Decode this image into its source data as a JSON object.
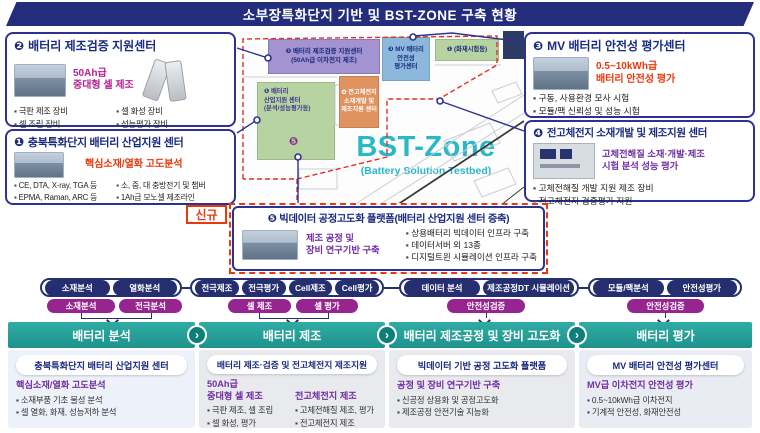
{
  "title": "소부장특화단지 기반 및 BST-ZONE  구축 현황",
  "badge_new": "신규",
  "colors": {
    "navy": "#2e3192",
    "title_bar": "#232d7b",
    "teal_header": "#23a39c",
    "red_accent": "#e8380d",
    "purple_accent": "#7030a0",
    "magenta_accent": "#b5208f",
    "bst_cyan": "#29b8c5",
    "dark_pill": "#252e6e",
    "purple_pill": "#97258f"
  },
  "boxes": {
    "b2": {
      "num": "❷",
      "title": "배터리 제조검증 지원센터",
      "hl1": "50Ah급",
      "hl2": "중대형 셀 제조",
      "bullets": [
        "극판 제조 장비",
        "셀 화성 장비",
        "셀 조립 장비",
        "성능평가 장비"
      ]
    },
    "b1": {
      "num": "❶",
      "title": "충북특화단지 배터리 산업지원 센터",
      "hl1": "핵심소재/열화 고도분석",
      "bullets": [
        "CE, DTA, X-ray, TGA 등",
        "소, 중, 대 충방전기 및 챔버",
        "EPMA, Raman, ARC 등",
        "1Ah급 모노셀 제조라인"
      ]
    },
    "b3": {
      "num": "❸",
      "title": "MV 배터리 안전성 평가센터",
      "hl1": "0.5~10kWh급",
      "hl2": "배터리 안전성 평가",
      "bullets": [
        "구동, 사용환경 모사 시험",
        "모듈/팩 신뢰성 및 성능 시험"
      ]
    },
    "b4": {
      "num": "❹",
      "title": "전고체전지 소재개발 및 제조지원 센터",
      "hl1": "고체전해질 소재·개발·제조",
      "hl2": "시험 분석 성능 평가",
      "bullets": [
        "고체전해질 개발 지원 제조 장비",
        "전고체전지 검증평가 지원"
      ]
    },
    "b5": {
      "num": "❺",
      "title": "빅데이터 공정고도화 플랫폼(배터리 산업지원 센터 증축)",
      "hl1": "제조 공정 및",
      "hl2": "장비 연구기반 구축",
      "bullets": [
        "상용배터리 빅데이터 인프라 구축",
        "데이터서버 외 13종",
        "디지털트윈 시뮬레이션 인프라 구축"
      ]
    }
  },
  "map": {
    "bst_title": "BST-Zone",
    "bst_subtitle": "(Battery Solution Testbed)",
    "marker5": "❺",
    "blocks": {
      "purple": {
        "line1": "❷ 배터리 제조검증 지원센터",
        "line2": "(50Ah급 이차전지 제조)"
      },
      "blue": {
        "line1": "❸ MV 배터리",
        "line2": "안전성",
        "line3": "평가센터"
      },
      "fire": {
        "line1": "❶ (화재시험동)"
      },
      "orange": {
        "line1": "❹ 전고체전지",
        "line2": "소재개발 및",
        "line3": "제조지원 센터"
      },
      "green": {
        "line1": "❶ 배터리",
        "line2": "산업지원 센터",
        "line3": "(분석/성능평가동)"
      }
    }
  },
  "flow": {
    "row1": {
      "g1": [
        "소재분석",
        "열화분석"
      ],
      "g2": [
        "전극제조",
        "전극평가",
        "Cell제조",
        "Cell평가"
      ],
      "g3": [
        "데이터 분석",
        "제조공정DT 시뮬레이션"
      ],
      "g4": [
        "모듈/팩분석",
        "안전성평가"
      ]
    },
    "row2": [
      "소재분석",
      "전극분석",
      "셀 제조",
      "셀 평가",
      "안전성검증",
      "안전성검증"
    ]
  },
  "chevron": "›",
  "columns": [
    {
      "header": "배터리 분석",
      "pill": "충북특화단지 배터리 산업지원 센터",
      "subtitle": "핵심소재/열화 고도분석",
      "bullets": [
        "소재부품 기초 물성 분석",
        "셀 열화, 화재, 성능저하 분석"
      ]
    },
    {
      "header": "배터리 제조",
      "pill": "배터리 제조·검증 및 전고체전지 제조지원",
      "left": {
        "sub1": "50Ah급",
        "sub2": "중대형 셀 제조",
        "bullets": [
          "극판 제조, 셀 조립",
          "셀 화성, 평가"
        ]
      },
      "right": {
        "sub1": "전고체전지 제조",
        "bullets": [
          "고체전해질 제조, 평가",
          "전고체전지 제조"
        ]
      }
    },
    {
      "header": "배터리 제조공정 및 장비 고도화",
      "pill": "빅데이터 기반 공정 고도화 플랫폼",
      "subtitle": "공정 및 장비 연구기반 구축",
      "bullets": [
        "신공정 상용화 및 공정고도화",
        "제조공정 안전기술 지능화"
      ]
    },
    {
      "header": "배터리 평가",
      "pill": "MV 배터리 안전성 평가센터",
      "subtitle": "MV급 이차전지 안전성 평가",
      "bullets": [
        "0.5~10kWh급 이차전지",
        "기계적 안전성, 화재안전성"
      ]
    }
  ]
}
